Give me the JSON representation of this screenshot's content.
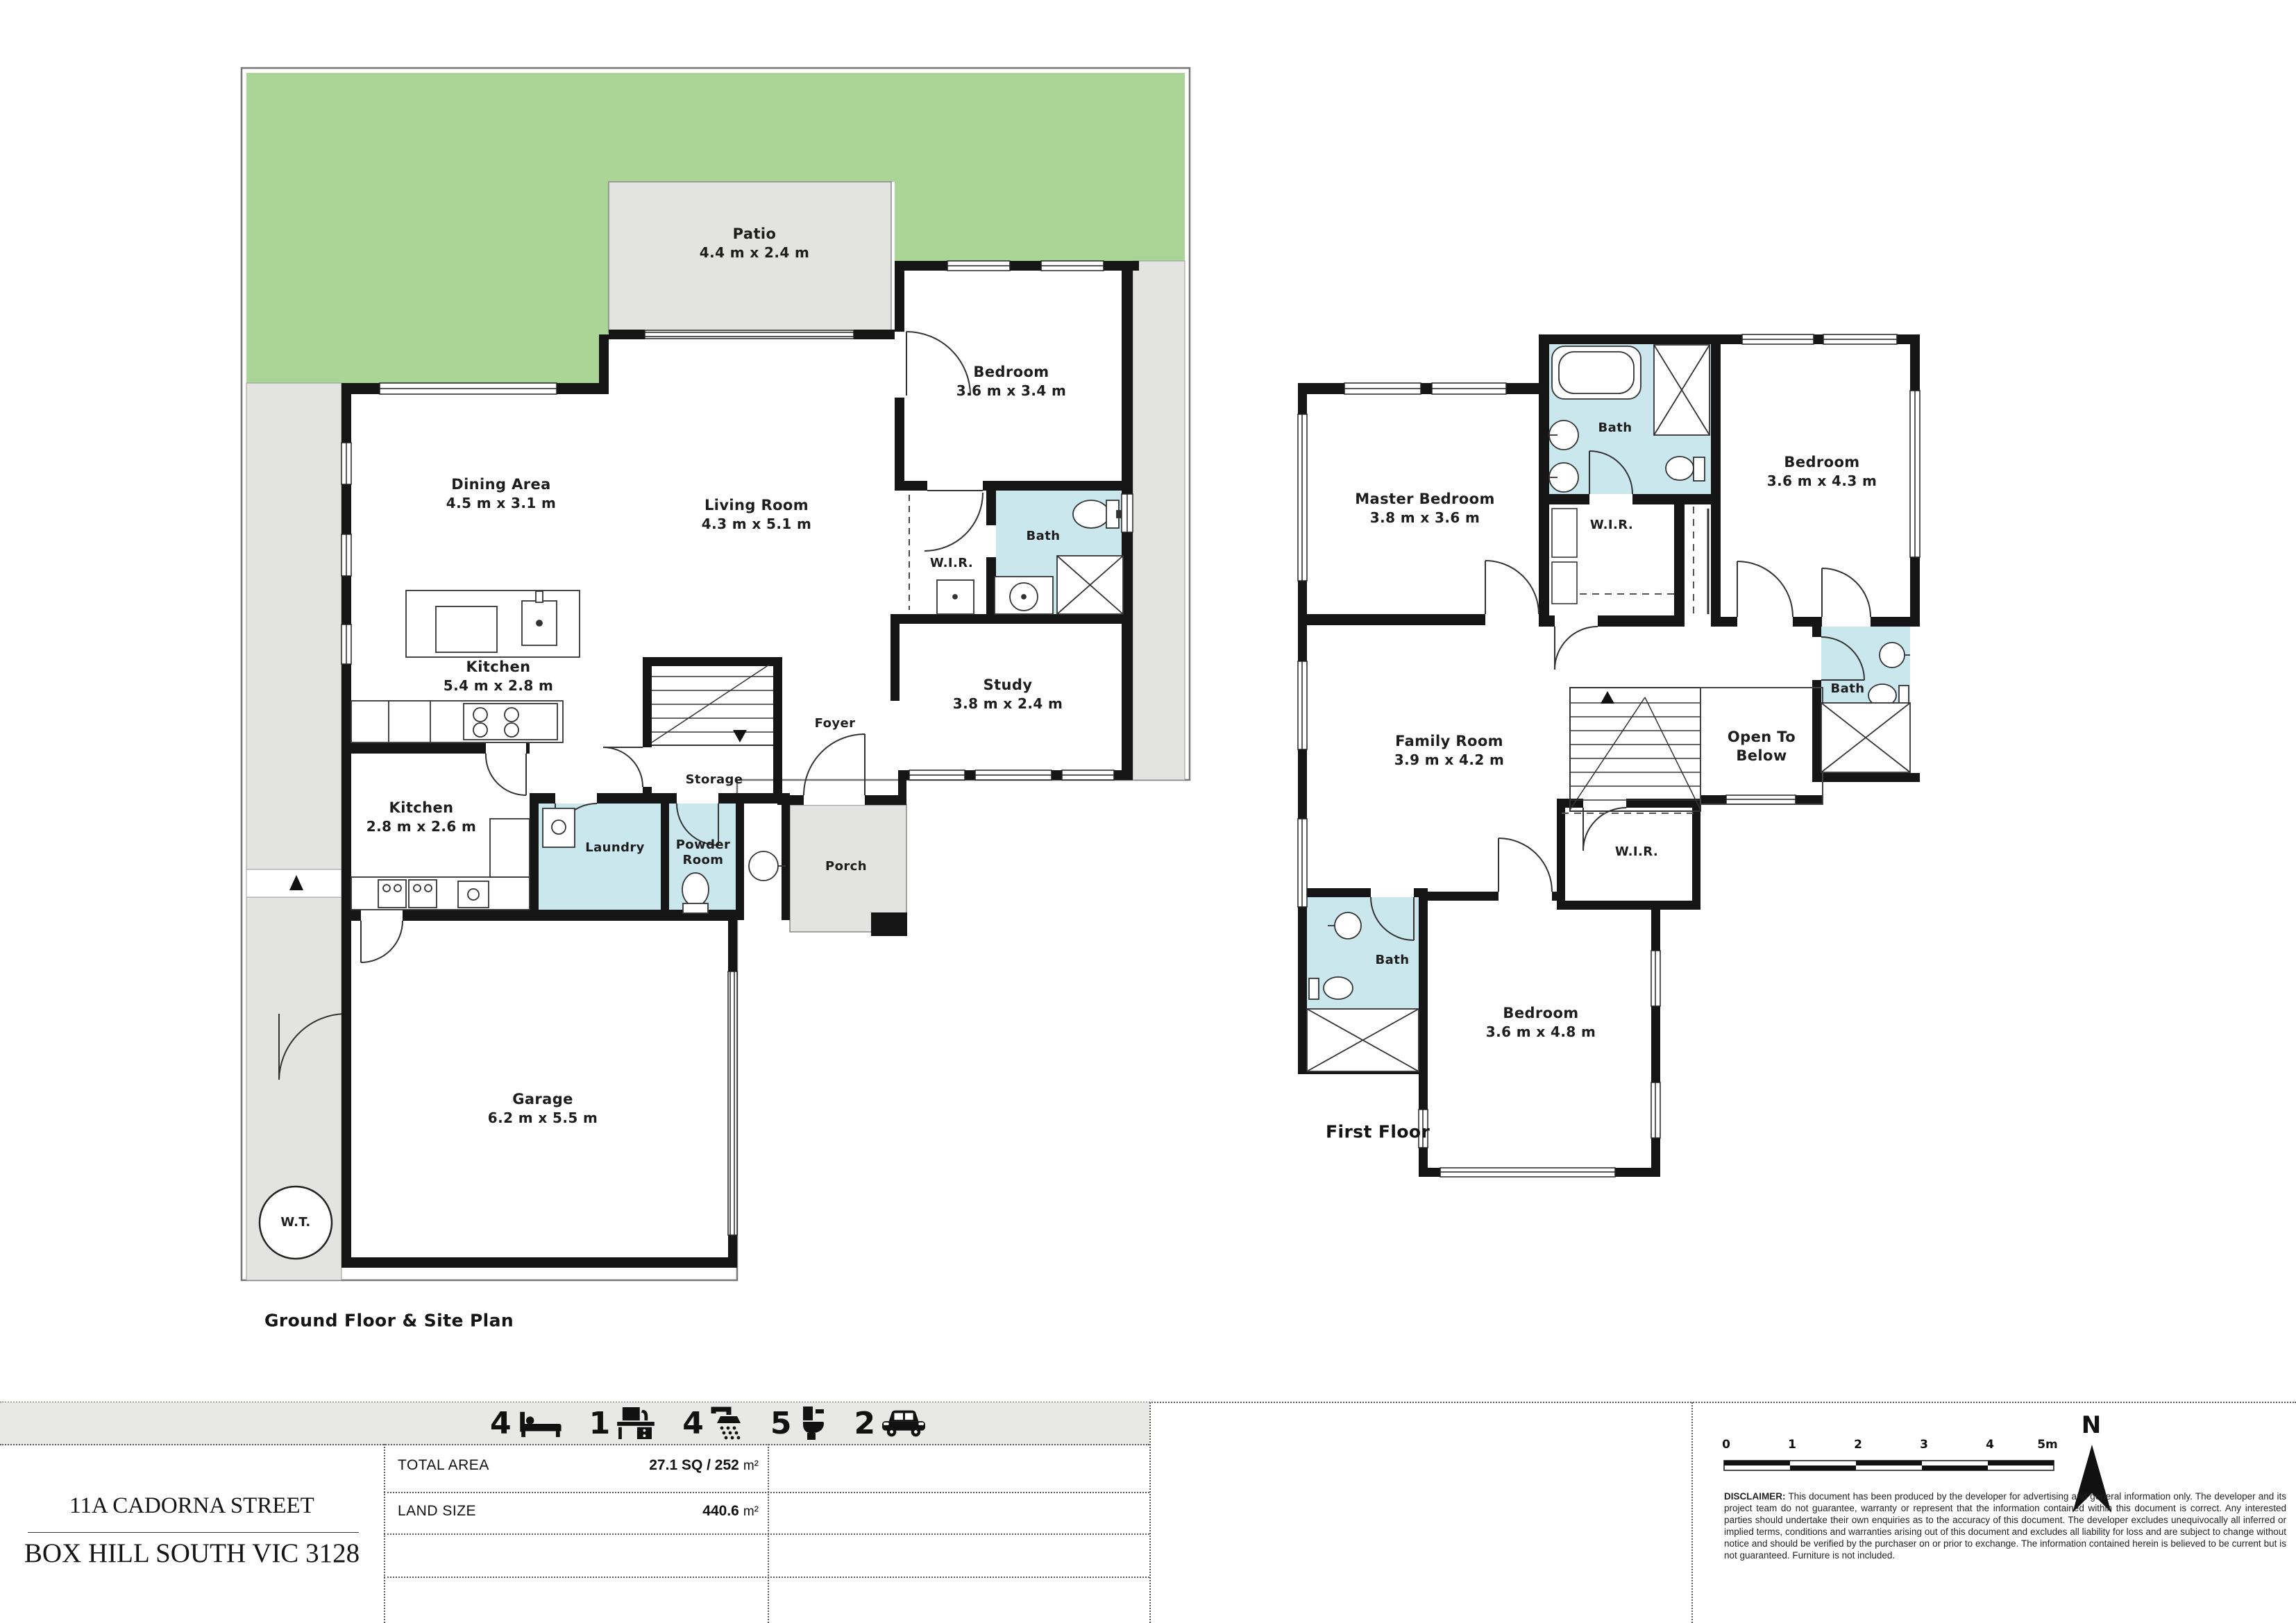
{
  "ground": {
    "title": "Ground Floor & Site Plan",
    "rooms": {
      "patio": {
        "name": "Patio",
        "dims": "4.4 m x 2.4 m"
      },
      "bedroom": {
        "name": "Bedroom",
        "dims": "3.6 m x 3.4 m"
      },
      "dining": {
        "name": "Dining Area",
        "dims": "4.5 m x 3.1 m"
      },
      "living": {
        "name": "Living Room",
        "dims": "4.3 m x 5.1 m"
      },
      "kitchen": {
        "name": "Kitchen",
        "dims": "5.4 m x 2.8 m"
      },
      "wir": {
        "name": "W.I.R."
      },
      "bath": {
        "name": "Bath"
      },
      "study": {
        "name": "Study",
        "dims": "3.8 m x 2.4 m"
      },
      "foyer": {
        "name": "Foyer"
      },
      "storage": {
        "name": "Storage"
      },
      "kitchen2": {
        "name": "Kitchen",
        "dims": "2.8 m x 2.6 m"
      },
      "laundry": {
        "name": "Laundry"
      },
      "powder": {
        "name": "Powder Room"
      },
      "porch": {
        "name": "Porch"
      },
      "garage": {
        "name": "Garage",
        "dims": "6.2 m x 5.5 m"
      },
      "water_tank": {
        "name": "W.T."
      }
    }
  },
  "first": {
    "title": "First Floor",
    "rooms": {
      "master": {
        "name": "Master Bedroom",
        "dims": "3.8 m x 3.6 m"
      },
      "ensuite": {
        "name": "Bath"
      },
      "wir_top": {
        "name": "W.I.R."
      },
      "bedroom2": {
        "name": "Bedroom",
        "dims": "3.6 m x 4.3 m"
      },
      "family": {
        "name": "Family Room",
        "dims": "3.9 m x 4.2 m"
      },
      "open_below": {
        "name": "Open To Below"
      },
      "bath_mid": {
        "name": "Bath"
      },
      "wir_lower": {
        "name": "W.I.R."
      },
      "bath_lower": {
        "name": "Bath"
      },
      "bedroom3": {
        "name": "Bedroom",
        "dims": "3.6 m x 4.8 m"
      }
    }
  },
  "summary": {
    "items": [
      {
        "count": "4",
        "icon": "bed-icon"
      },
      {
        "count": "1",
        "icon": "study-desk-icon"
      },
      {
        "count": "4",
        "icon": "shower-icon"
      },
      {
        "count": "5",
        "icon": "toilet-icon"
      },
      {
        "count": "2",
        "icon": "car-icon"
      }
    ]
  },
  "details": {
    "total_area_label": "TOTAL AREA",
    "total_area_value": "27.1 SQ / 252",
    "total_area_unit": "m²",
    "land_size_label": "LAND SIZE",
    "land_size_value": "440.6",
    "land_size_unit": "m²"
  },
  "address": {
    "line1": "11A CADORNA STREET",
    "line2": "BOX HILL SOUTH VIC 3128"
  },
  "scale_bar": {
    "ticks": [
      "0",
      "1",
      "2",
      "3",
      "4",
      "5m"
    ],
    "north_label": "N"
  },
  "disclaimer": {
    "label": "DISCLAIMER:",
    "text": " This document has been produced by the developer for advertising and general information only. The developer and its project team do not guarantee, warranty or represent that the information contained within this document is correct. Any interested parties should undertake their own enquiries as to the accuracy of this document. The developer excludes unequivocally all inferred or implied terms, conditions and warranties arising out of this document and excludes all liability for loss and are subject to change without notice and should be verified by the purchaser on or prior to exchange. The information contained herein is believed to be current but is not guaranteed. Furniture is not included."
  },
  "colors": {
    "garden": "#abd596",
    "paving": "#e3e3e1",
    "wet_area": "#cbe7ee",
    "wall": "#151515"
  }
}
